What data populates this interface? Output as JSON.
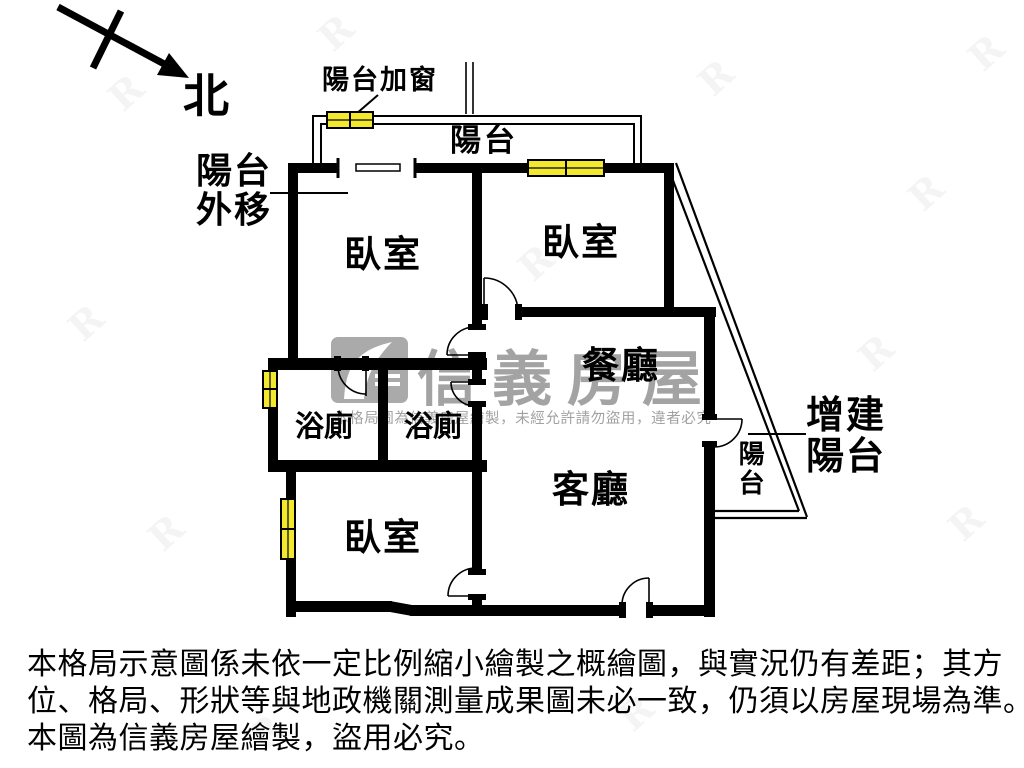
{
  "compass": {
    "north_label": "北"
  },
  "plan": {
    "labels": {
      "balcony_add_window": "陽台加窗",
      "balcony_top": "陽台",
      "balcony_moved_out": "陽台外移",
      "bedroom_top_left": "臥室",
      "bedroom_top_right": "臥室",
      "bedroom_bottom": "臥室",
      "bath_left": "浴廁",
      "bath_right": "浴廁",
      "dining_room": "餐廳",
      "living_room": "客廳",
      "balcony_side": "陽台",
      "added_balcony": "增建陽台"
    }
  },
  "watermark": {
    "brand": "信義房屋",
    "notice": "本格局圖為信義房屋繪製，未經允許請勿盜用，違者必究"
  },
  "disclaimer": {
    "line1": "本格局示意圖係未依一定比例縮小繪製之概繪圖，與實況仍有差距；其方",
    "line2": "位、格局、形狀等與地政機關測量成果圖未必一致，仍須以房屋現場為準。",
    "line3": "本圖為信義房屋繪製，盜用必究。"
  },
  "colors": {
    "wall": "#000000",
    "window_fill": "#f2e82e",
    "watermark_gray": "#9f9f9f"
  }
}
